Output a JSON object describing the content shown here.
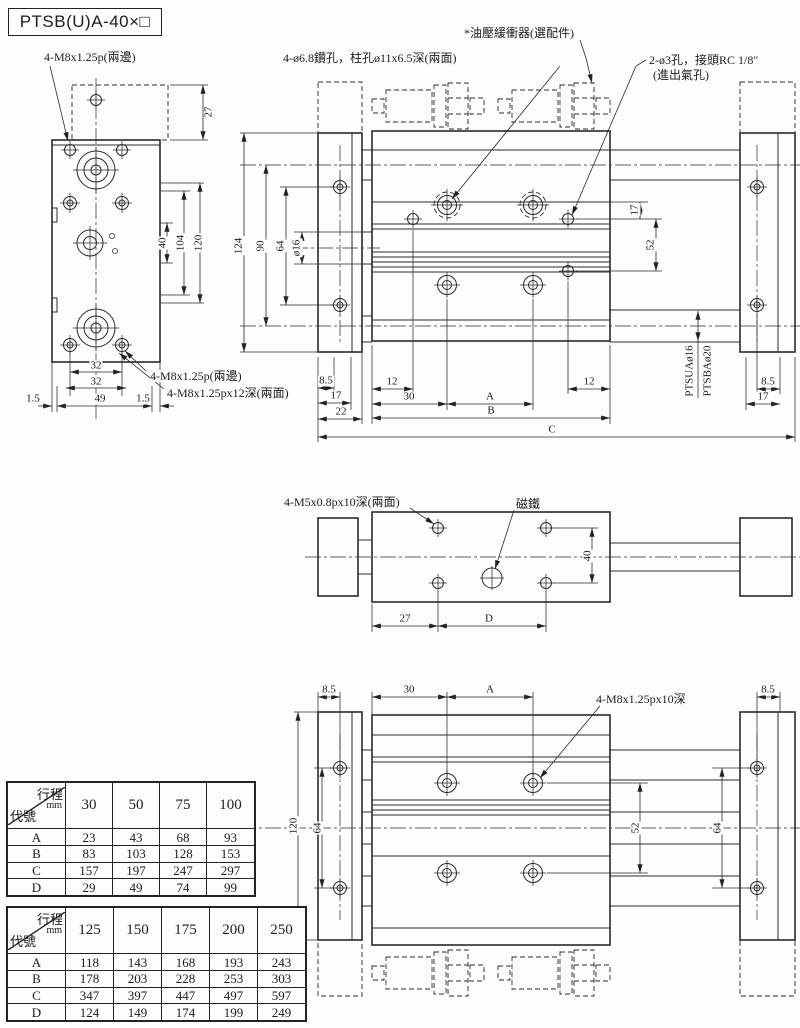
{
  "title": "PTSB(U)A-40×□",
  "annotations": {
    "thread_top_left": "4-M8x1.25p(兩邊)",
    "drill_note": "4-ø6.8鑽孔，柱孔ø11x6.5深(兩面)",
    "shock_absorber_note": "*油壓緩衝器(選配件)",
    "air_port_note_line1": "2-ø3孔，接頭RC 1/8\"",
    "air_port_note_line2": "(進出氣孔)",
    "thread_bottom_left_1": "4-M8x1.25p(兩邊)",
    "thread_bottom_left_2": "4-M8x1.25px12深(兩面)",
    "thread_mid_view": "4-M5x0.8px10深(兩面)",
    "magnet_label": "磁鐵",
    "thread_bottom_view": "4-M8x1.25px10深",
    "rod_model_1": "PTSUAø16",
    "rod_model_2": "PTSBAø20"
  },
  "dims": {
    "d1_5": "1.5",
    "d8_5": "8.5",
    "d12": "12",
    "d16": "ø16",
    "d17": "17",
    "d22": "22",
    "d27": "27",
    "d30": "30",
    "d32": "32",
    "d40": "40",
    "d49": "49",
    "d52": "52",
    "d64": "64",
    "d90": "90",
    "d104": "104",
    "d120": "120",
    "d124": "124",
    "dA": "A",
    "dB": "B",
    "dC": "C",
    "dD": "D"
  },
  "stroke_table_1": {
    "corner_top": "行程",
    "corner_unit": "mm",
    "corner_bottom": "代號",
    "columns": [
      "30",
      "50",
      "75",
      "100"
    ],
    "rows": [
      {
        "label": "A",
        "values": [
          "23",
          "43",
          "68",
          "93"
        ]
      },
      {
        "label": "B",
        "values": [
          "83",
          "103",
          "128",
          "153"
        ]
      },
      {
        "label": "C",
        "values": [
          "157",
          "197",
          "247",
          "297"
        ]
      },
      {
        "label": "D",
        "values": [
          "29",
          "49",
          "74",
          "99"
        ]
      }
    ]
  },
  "stroke_table_2": {
    "corner_top": "行程",
    "corner_unit": "mm",
    "corner_bottom": "代號",
    "columns": [
      "125",
      "150",
      "175",
      "200",
      "250"
    ],
    "rows": [
      {
        "label": "A",
        "values": [
          "118",
          "143",
          "168",
          "193",
          "243"
        ]
      },
      {
        "label": "B",
        "values": [
          "178",
          "203",
          "228",
          "253",
          "303"
        ]
      },
      {
        "label": "C",
        "values": [
          "347",
          "397",
          "447",
          "497",
          "597"
        ]
      },
      {
        "label": "D",
        "values": [
          "124",
          "149",
          "174",
          "199",
          "249"
        ]
      }
    ]
  }
}
